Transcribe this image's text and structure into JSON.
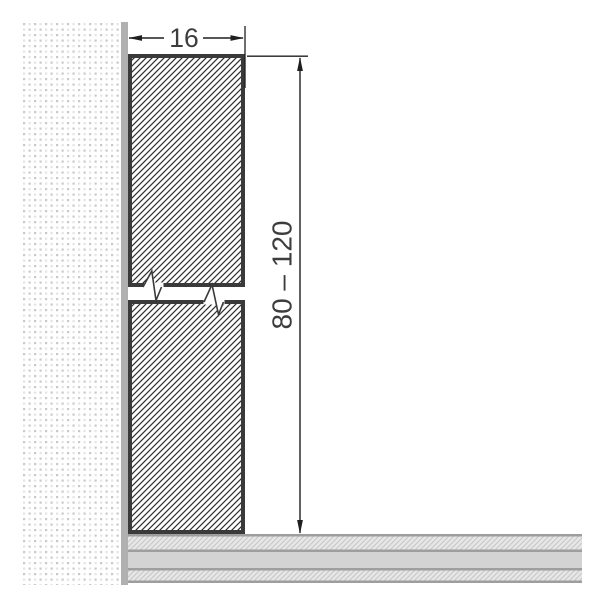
{
  "drawing": {
    "title": "skirting-profile-cross-section",
    "dimensions": {
      "width": {
        "label": "16"
      },
      "height": {
        "label": "80 – 120"
      }
    }
  },
  "colors": {
    "line": "#3a3a3a",
    "dim_line": "#1f1f1f",
    "text": "#3d3d3d",
    "wall_strip": "#b0b0b0",
    "stipple_dark": "#c9c9c9",
    "stipple_light": "#e4e4e4",
    "hatch_line": "#2f2f2f",
    "floor_line": "#9e9e9e",
    "floor_solid": "#d3d3d3",
    "floor_hatch_bg": "#e7e7e7",
    "floor_hatch_line": "#c6c6c6"
  }
}
